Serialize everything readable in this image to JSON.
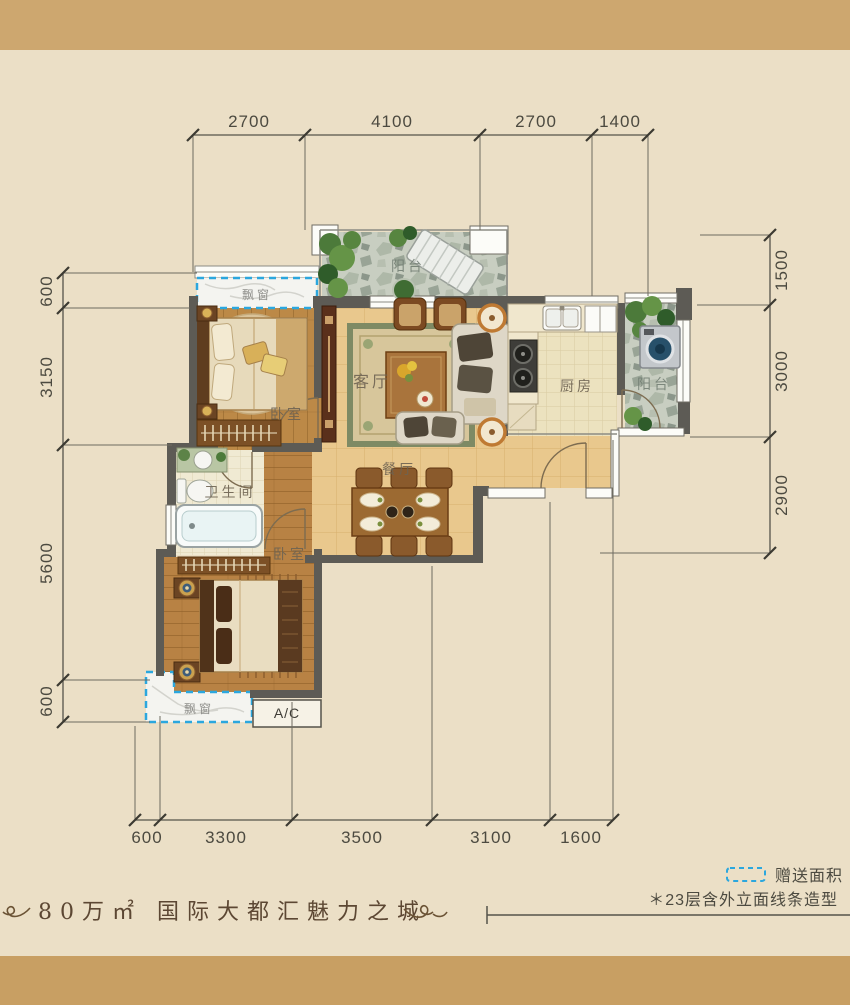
{
  "dims": {
    "top": [
      "2700",
      "4100",
      "2700",
      "1400"
    ],
    "left": [
      "600",
      "3150",
      "5600",
      "600"
    ],
    "right": [
      "1500",
      "3000",
      "2900"
    ],
    "bottom": [
      "600",
      "3300",
      "3500",
      "3100",
      "1600"
    ]
  },
  "rooms": {
    "balcony_top": "阳台",
    "bay_top": "飘窗",
    "bedroom_top": "卧室",
    "living": "客厅",
    "kitchen": "厨房",
    "balcony_right": "阳台",
    "dining": "餐厅",
    "bathroom": "卫生间",
    "bedroom_bottom": "卧室",
    "bay_bottom": "飘窗",
    "ac_platform": "A/C"
  },
  "legend": {
    "gift_area": "赠送面积",
    "floor_note": "＊23层含外立面线条造型"
  },
  "footer": {
    "slogan": "80万㎡ 国际大都汇魅力之城"
  },
  "colors": {
    "accent_dash": "#2ba7de",
    "paper": "#ebdfc6",
    "kraft_band": "#cda76f",
    "wall": "#5d5b55",
    "wood_floor": "#bc8947",
    "tile_floor": "#e9c88d",
    "stone_floor": "#c8cec1",
    "title_brown": "#5c4733"
  }
}
